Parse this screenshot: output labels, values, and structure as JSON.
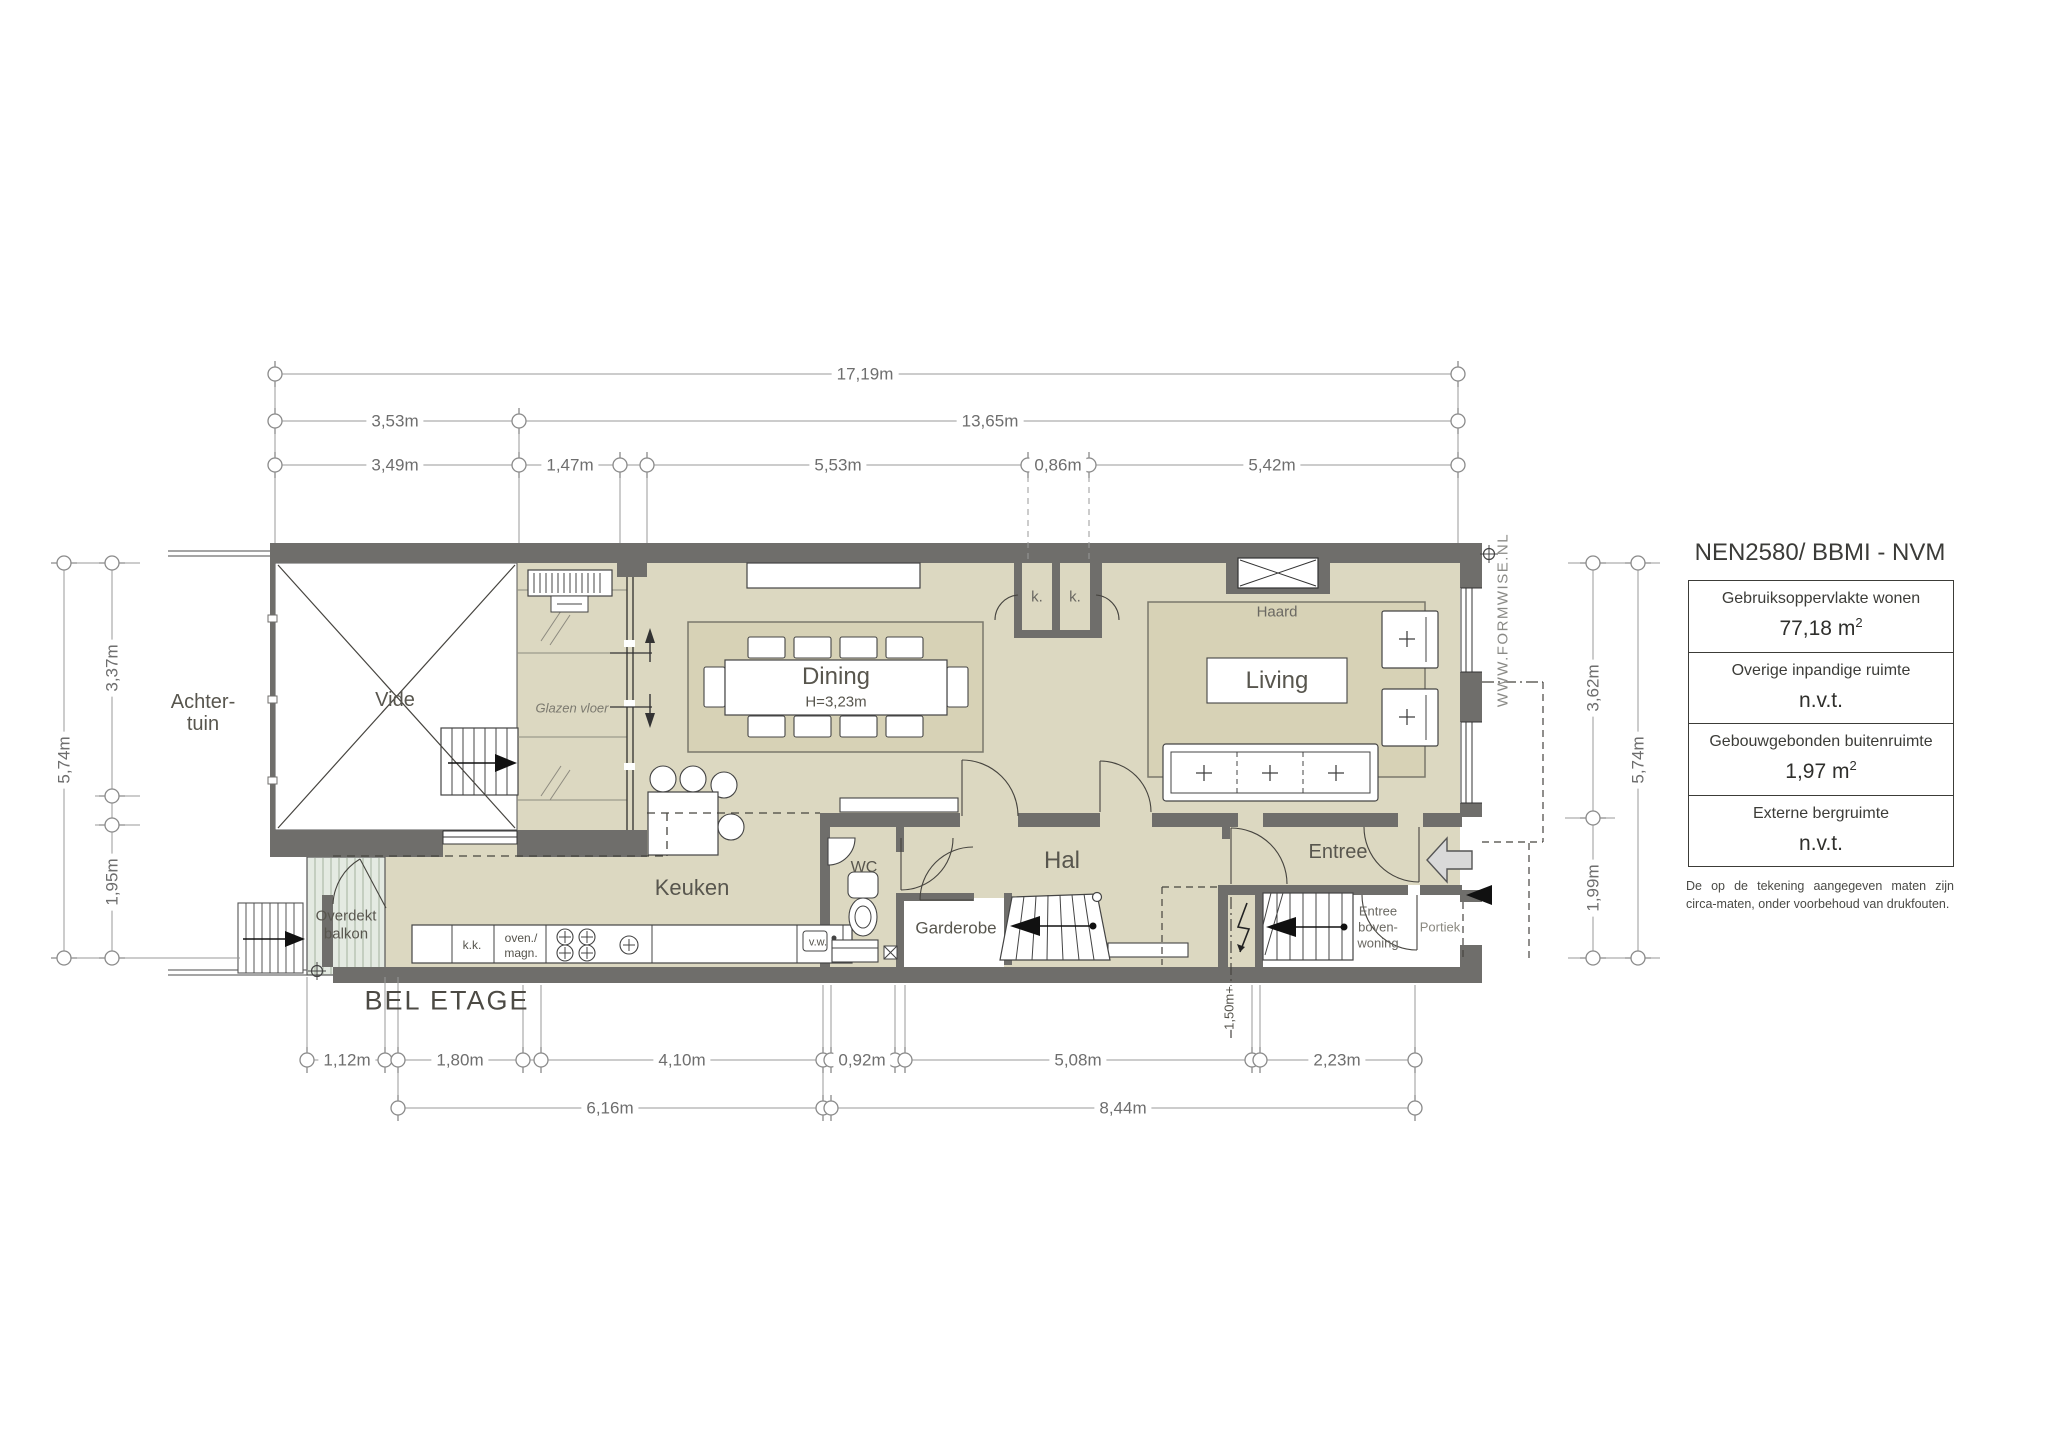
{
  "plan_title": "BEL ETAGE",
  "watermark": "WWW.FORMWISE.NL",
  "standard_title": "NEN2580/ BBMI - NVM",
  "legend": {
    "rows": [
      {
        "label": "Gebruiksoppervlakte wonen",
        "value": "77,18 m",
        "sup": "2"
      },
      {
        "label": "Overige inpandige ruimte",
        "value": "n.v.t.",
        "sup": ""
      },
      {
        "label": "Gebouwgebonden buitenruimte",
        "value": "1,97 m",
        "sup": "2"
      },
      {
        "label": "Externe bergruimte",
        "value": "n.v.t.",
        "sup": ""
      }
    ],
    "footnote": "De op de tekening aangegeven maten zijn circa-maten, onder voorbehoud van drukfouten."
  },
  "rooms": {
    "achtertuin_1": "Achter-",
    "achtertuin_2": "tuin",
    "vide": "Vide",
    "glazen_vloer": "Glazen vloer",
    "dining": "Dining",
    "dining_height": "H=3,23m",
    "closet_1": "k.",
    "closet_2": "k.",
    "haard": "Haard",
    "living": "Living",
    "keuken": "Keuken",
    "wc": "WC",
    "hal": "Hal",
    "garderobe": "Garderobe",
    "entree": "Entree",
    "entree_boven_1": "Entree",
    "entree_boven_2": "boven-",
    "entree_boven_3": "woning",
    "portiek": "Portiek",
    "balkon_1": "Overdekt",
    "balkon_2": "balkon",
    "kitchen_kk": "k.k.",
    "kitchen_oven_1": "oven./",
    "kitchen_oven_2": "magn.",
    "kitchen_vw": "v.w."
  },
  "dimensions": {
    "top": [
      "17,19m",
      "3,53m",
      "13,65m",
      "3,49m",
      "1,47m",
      "5,53m",
      "0,86m",
      "5,42m"
    ],
    "bottom": [
      "1,12m",
      "1,80m",
      "4,10m",
      "0,92m",
      "5,08m",
      "2,23m",
      "6,16m",
      "8,44m"
    ],
    "left": [
      "5,74m",
      "3,37m",
      "1,95m"
    ],
    "right": [
      "3,62m",
      "5,74m",
      "1,99m"
    ],
    "stair_height": "1,50m+"
  }
}
